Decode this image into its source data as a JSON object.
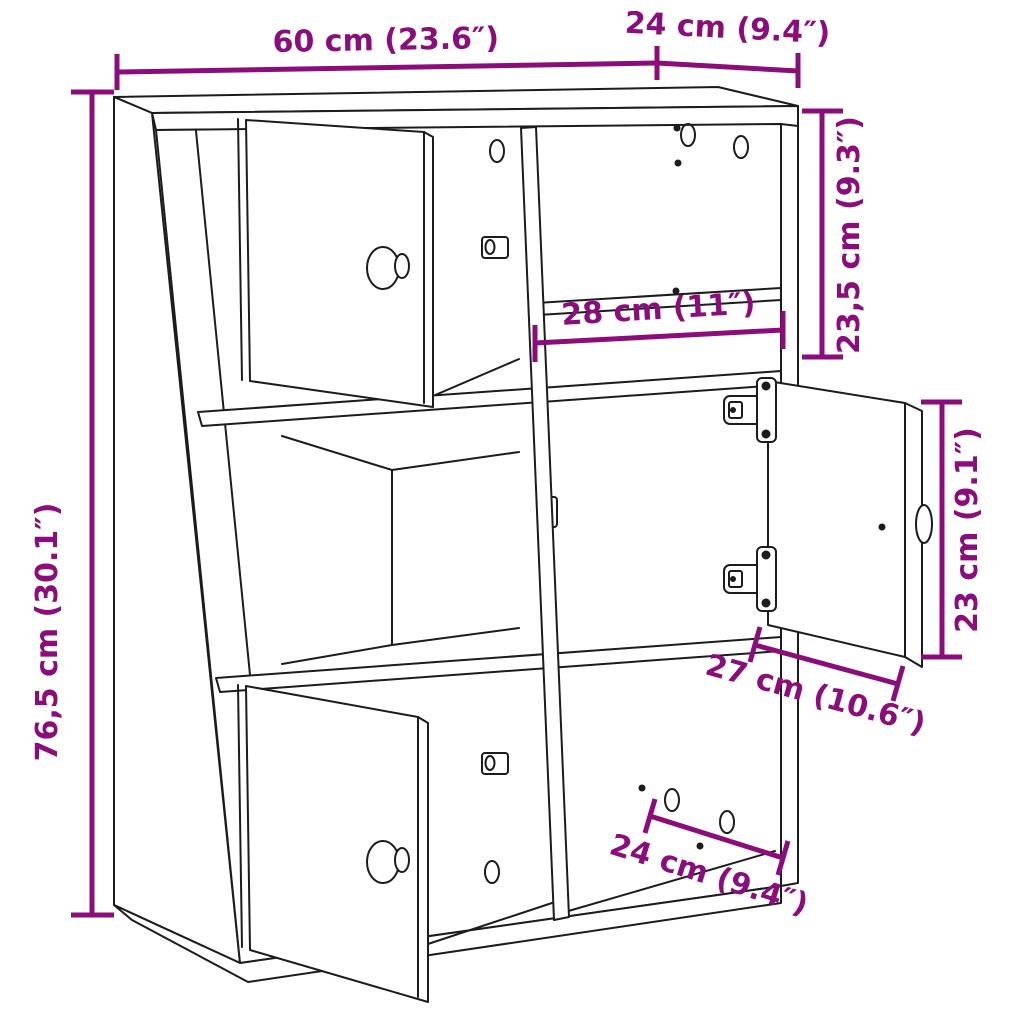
{
  "colors": {
    "dimension": "#8B0D7B",
    "line": "#1c1c1c",
    "background": "#ffffff"
  },
  "dims": {
    "top_width": "60 cm (23.6″)",
    "top_depth": "24 cm (9.4″)",
    "right_upper_section": "23,5 cm (9.3″)",
    "left_height": "76,5 cm (30.1″)",
    "inner_shelf_width": "28 cm (11″)",
    "right_door_height": "23 cm (9.1″)",
    "bottom_inner_width": "27 cm (10.6″)",
    "bottom_depth": "24 cm (9.4″)"
  }
}
